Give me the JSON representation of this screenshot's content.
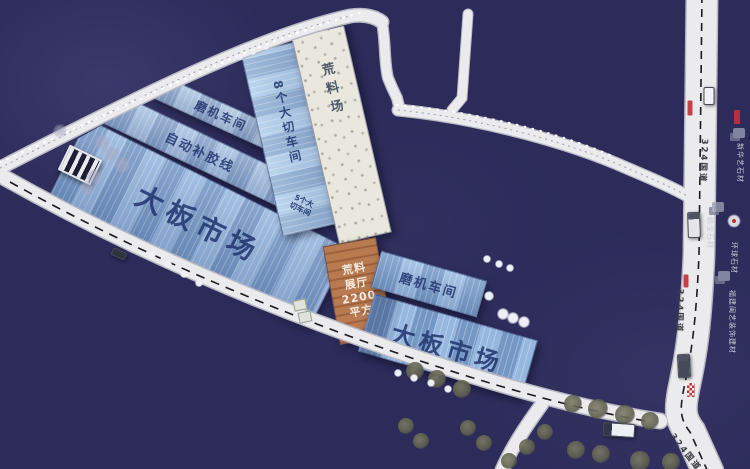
{
  "buildings": {
    "grinding_workshop_1": {
      "label": "磨机车间"
    },
    "auto_glue_line": {
      "label": "自动补胶线"
    },
    "slab_market_1": {
      "label": "大板市场"
    },
    "eight_cutting_workshop": {
      "label": "8个大切车间"
    },
    "five_cutting_workshop": {
      "line1": "5个大",
      "line2": "切车间"
    },
    "raw_material_yard": {
      "label": "荒料场"
    },
    "raw_material_hall": {
      "line1": "荒料",
      "line2": "展厅",
      "line3": "2200",
      "line4": "平方"
    },
    "grinding_workshop_2": {
      "label": "磨机车间"
    },
    "slab_market_2": {
      "label": "大板市场"
    }
  },
  "roads": {
    "national_highway_label": "324国道",
    "g324_positions": [
      {
        "x": 704,
        "y": 161,
        "angle": 93
      },
      {
        "x": 680,
        "y": 311,
        "angle": 92
      },
      {
        "x": 686,
        "y": 452,
        "angle": 52
      }
    ]
  },
  "roadside_companies": [
    {
      "text": "新华艺石材",
      "x": 740,
      "y": 163,
      "angle": 90
    },
    {
      "text": "鹏宝石材",
      "x": 710,
      "y": 233,
      "angle": 90
    },
    {
      "text": "环球石材",
      "x": 734,
      "y": 258,
      "angle": 90
    },
    {
      "text": "福建闽艺装饰建材",
      "x": 732,
      "y": 322,
      "angle": 90
    }
  ],
  "colors": {
    "background": "#2c2b5a",
    "road_fill": "#ebebee",
    "road_casing": "#b8b8c4",
    "roof_blue": "#8aaed8",
    "roof_blue_light": "#a9c9ea",
    "yard_speckle": "#e9e7de",
    "hall_orange": "#b97a50",
    "building_text": "#1e326c",
    "highway_marker_red": "#c4303a"
  },
  "decor": {
    "trees_olive": [
      [
        415,
        371,
        9
      ],
      [
        437,
        379,
        9
      ],
      [
        462,
        389,
        9
      ],
      [
        573,
        404,
        9
      ],
      [
        598,
        409,
        10
      ],
      [
        625,
        415,
        10
      ],
      [
        650,
        421,
        9
      ],
      [
        576,
        450,
        9
      ],
      [
        601,
        454,
        9
      ],
      [
        640,
        461,
        10
      ],
      [
        671,
        462,
        9
      ],
      [
        545,
        432,
        8
      ],
      [
        527,
        447,
        8
      ],
      [
        509,
        461,
        8
      ],
      [
        406,
        426,
        8
      ],
      [
        421,
        441,
        8
      ],
      [
        468,
        428,
        8
      ],
      [
        484,
        443,
        8
      ]
    ],
    "dots_white": [
      [
        152,
        255,
        4
      ],
      [
        168,
        264,
        4
      ],
      [
        184,
        274,
        4
      ],
      [
        199,
        283,
        4
      ],
      [
        398,
        373,
        4
      ],
      [
        414,
        378,
        4
      ],
      [
        431,
        383,
        4
      ],
      [
        448,
        389,
        4
      ],
      [
        487,
        259,
        4
      ],
      [
        499,
        264,
        4
      ],
      [
        510,
        268,
        4
      ],
      [
        503,
        314,
        6
      ],
      [
        513,
        318,
        6
      ],
      [
        524,
        322,
        6
      ],
      [
        489,
        296,
        5
      ],
      [
        240,
        57,
        3
      ],
      [
        253,
        52,
        3
      ],
      [
        266,
        47,
        3
      ]
    ],
    "trees_gray": [
      [
        102,
        142,
        8
      ],
      [
        112,
        154,
        8
      ],
      [
        122,
        165,
        8
      ],
      [
        94,
        177,
        8
      ],
      [
        87,
        188,
        7
      ],
      [
        60,
        131,
        7
      ]
    ],
    "gray_blobs": [
      [
        739,
        133
      ],
      [
        718,
        207
      ],
      [
        724,
        276
      ]
    ],
    "circle_logo": {
      "x": 734,
      "y": 221
    },
    "red_markers": [
      {
        "x": 690,
        "y": 108,
        "w": 5,
        "h": 15
      },
      {
        "x": 737,
        "y": 117,
        "w": 6,
        "h": 14
      },
      {
        "x": 686,
        "y": 281,
        "w": 5,
        "h": 13
      },
      {
        "x": 691,
        "y": 390,
        "w": 8,
        "h": 14,
        "checker": true
      }
    ],
    "vehicles": [
      {
        "name": "truck-north",
        "x": 694,
        "y": 225,
        "w": 11,
        "h": 24,
        "angle": -2,
        "body": "#e6e6ea",
        "cab": 180
      },
      {
        "name": "truck-mid",
        "x": 684,
        "y": 366,
        "w": 11,
        "h": 22,
        "angle": -3,
        "body": "#454b59",
        "cab": 180
      },
      {
        "name": "truck-west",
        "x": 619,
        "y": 430,
        "w": 30,
        "h": 12,
        "angle": 4,
        "body": "#eceff3",
        "cab": 90
      },
      {
        "name": "car-southwest",
        "x": 119,
        "y": 254,
        "w": 13,
        "h": 6,
        "angle": 24,
        "body": "#2e3340",
        "cab": 0
      },
      {
        "name": "road-sign-white",
        "x": 709,
        "y": 96,
        "w": 9,
        "h": 16,
        "angle": 0,
        "body": "#f2f2f6",
        "cab": 0
      }
    ],
    "annex_huts": [
      [
        300,
        305
      ],
      [
        305,
        317
      ]
    ]
  }
}
